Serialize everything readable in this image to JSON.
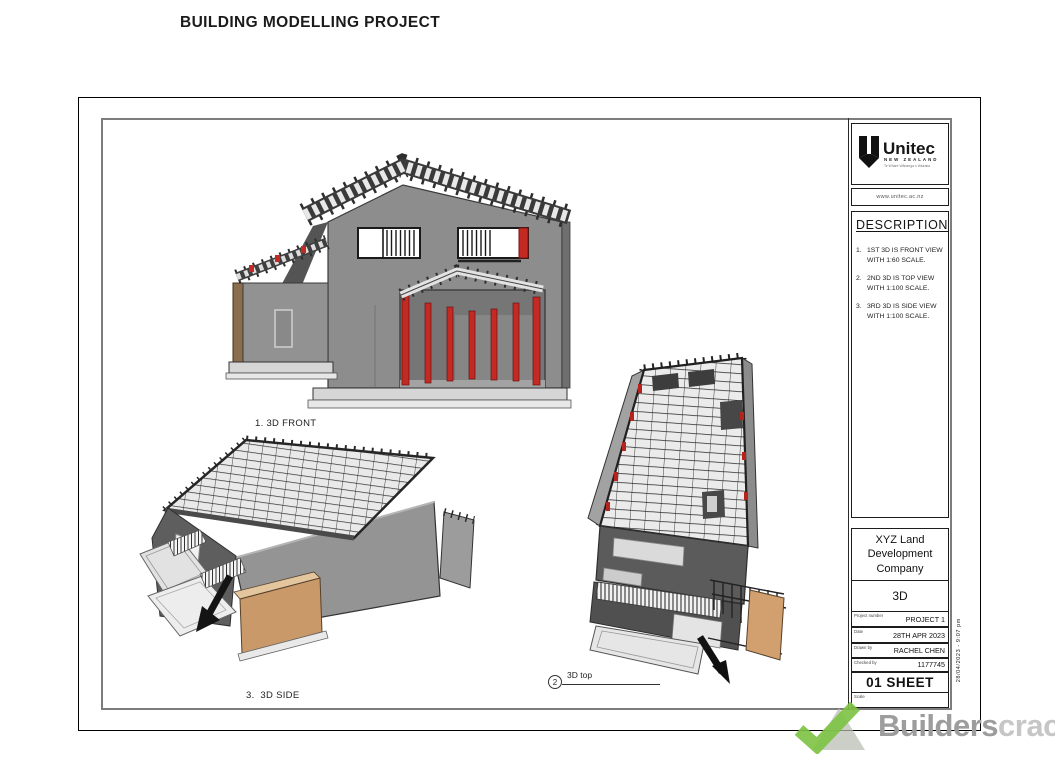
{
  "page": {
    "title": "BUILDING MODELLING PROJECT"
  },
  "views": {
    "front": {
      "label": "1. 3D FRONT"
    },
    "side": {
      "label": "3.  3D SIDE"
    },
    "top": {
      "number": "2",
      "label": "3D top"
    }
  },
  "title_block": {
    "logo": {
      "name": "Unitec",
      "region": "NEW ZEALAND",
      "tagline": "Te Whare Wānanga o Wairaka",
      "website": "www.unitec.ac.nz"
    },
    "description": {
      "heading": "DESCRIPTION",
      "items": [
        {
          "num": "1.",
          "text": "1ST 3D IS FRONT VIEW WITH 1:60 SCALE."
        },
        {
          "num": "2.",
          "text": "2ND 3D IS TOP VIEW WITH 1:100 SCALE."
        },
        {
          "num": "3.",
          "text": "3RD 3D IS SIDE VIEW WITH 1:100 SCALE."
        }
      ]
    },
    "company": "XYZ Land Development Company",
    "sheet_name": "3D",
    "fields": [
      {
        "label": "Project number",
        "value": "PROJECT 1"
      },
      {
        "label": "Date",
        "value": "28TH APR 2023"
      },
      {
        "label": "Drawn by",
        "value": "RACHEL CHEN"
      },
      {
        "label": "Checked by",
        "value": "1177745"
      }
    ],
    "sheet_number": "01 SHEET",
    "scale_label": "Scale",
    "plot_stamp": "28/04/2023 - 9:07 pm"
  },
  "watermark": {
    "bold": "Builders",
    "light": "crack"
  },
  "colors": {
    "accent_red": "#c32a24",
    "wall_gray": "#8d8d8d",
    "timber_tan": "#c9996a",
    "watermark_green": "#7cc242"
  }
}
